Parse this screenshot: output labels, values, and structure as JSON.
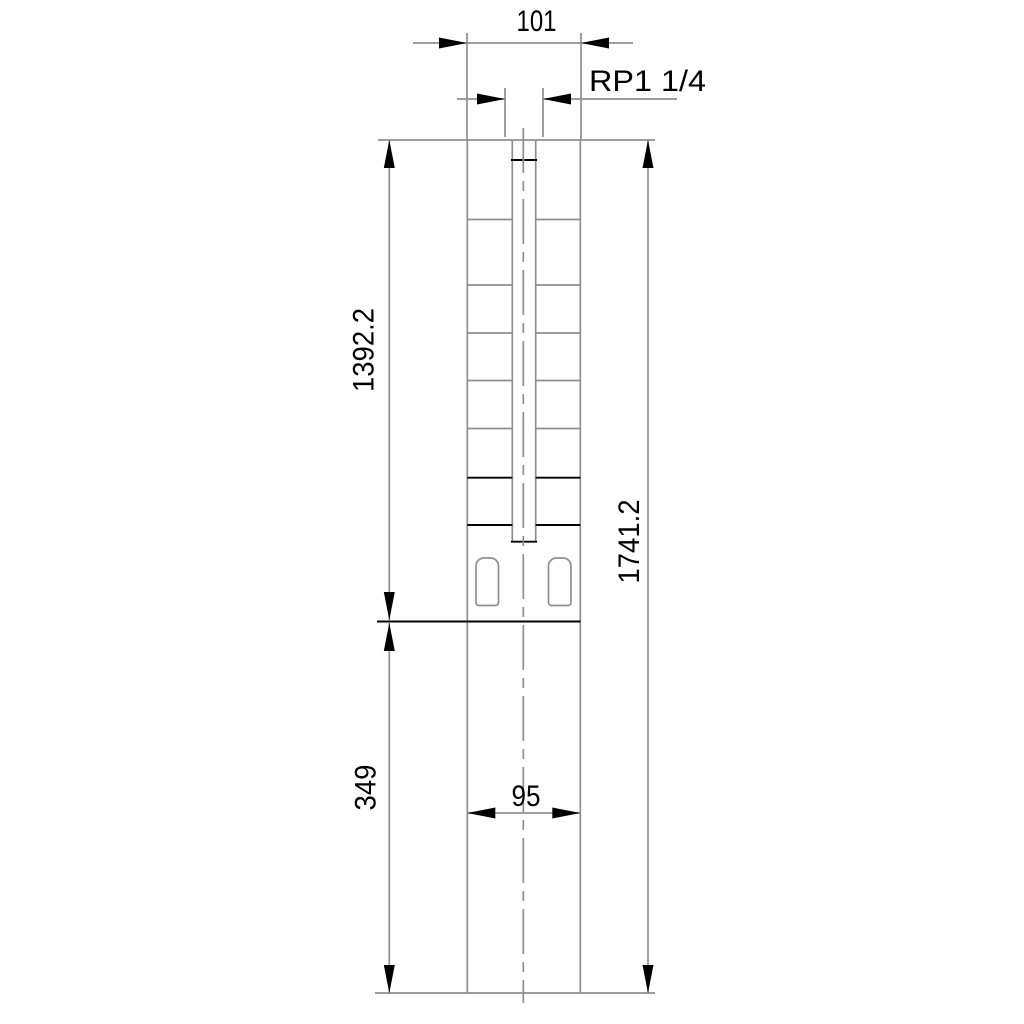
{
  "drawing": {
    "kind": "technical-dimension-drawing",
    "subject": "submersible borehole pump outline, front view",
    "background_color": "#ffffff",
    "outline_color": "#8f8f8f",
    "annotation_color": "#000000",
    "dimensions": {
      "discharge_port_width": "101",
      "discharge_thread": "RP1 1/4",
      "pump_section_length": "1392.2",
      "overall_length": "1741.2",
      "motor_section_length": "349",
      "motor_diameter": "95"
    }
  }
}
